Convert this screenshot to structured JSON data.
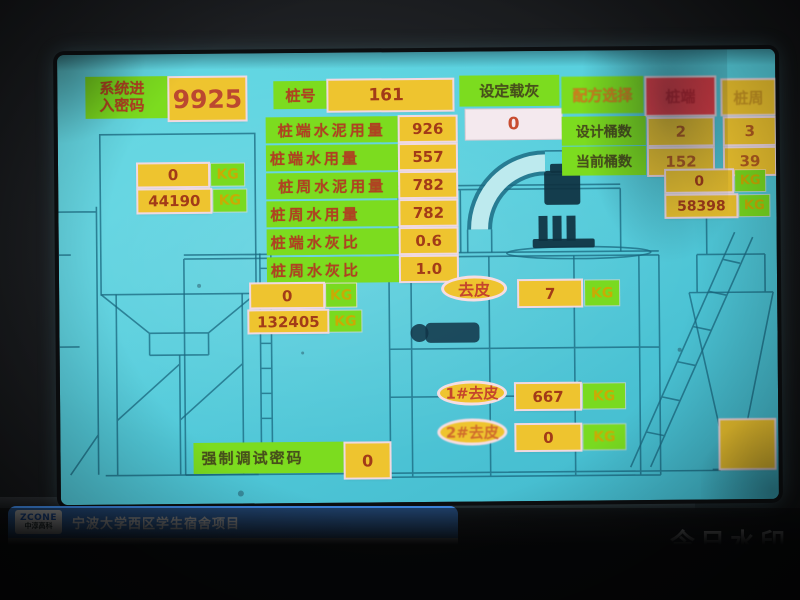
{
  "screen": {
    "password": {
      "label": "系统进入密码",
      "value": "9925"
    },
    "pile": {
      "label": "桩号",
      "value": "161"
    },
    "set_load": {
      "label": "设定载灰",
      "value": "0"
    },
    "recipe": {
      "label": "配方选择",
      "option_end": "桩端",
      "option_side": "桩周"
    },
    "buckets": {
      "design": {
        "label": "设计桶数",
        "end": "2",
        "side": "3"
      },
      "current": {
        "label": "当前桶数",
        "end": "152",
        "side": "39"
      }
    },
    "params": {
      "rows": [
        {
          "label": "桩端水泥用量",
          "value": "926"
        },
        {
          "label": "桩端水用量",
          "value": "557"
        },
        {
          "label": "桩周水泥用量",
          "value": "782"
        },
        {
          "label": "桩周水用量",
          "value": "782"
        },
        {
          "label": "桩端水灰比",
          "value": "0.6"
        },
        {
          "label": "桩周水灰比",
          "value": "1.0"
        }
      ]
    },
    "weights": {
      "unit": "KG",
      "left_top": "0",
      "left_bottom": "44190",
      "right_top": "0",
      "right_bottom": "58398",
      "mid_top": "0",
      "mid_bottom": "132405",
      "mixer_current": "7",
      "tare1_value": "667",
      "tare2_value": "0"
    },
    "tare": {
      "main": "去皮",
      "one": "1#去皮",
      "two": "2#去皮"
    },
    "debug": {
      "label": "强制调试密码",
      "value": "0"
    }
  },
  "watermark": {
    "logo": {
      "brand": "ZCONE",
      "company": "中淳高科"
    },
    "title": "宁波大学西区学生宿舍项目",
    "rows": [
      {
        "label": "施 工 内 容:",
        "value": "根植桩施工"
      },
      {
        "label": "拍 摄 时 间:",
        "value": "2025.11.11 10:09"
      },
      {
        "label": "地　　　点:",
        "value": "宁波市江北区·宁波大学西校区"
      }
    ],
    "brand": {
      "line1": "今日水印",
      "line2_prefix": "相机",
      "badge": "真实可验",
      "anti_fake_label": "防伪",
      "anti_fake_code": "TAAUHDX41AY1CM"
    }
  }
}
